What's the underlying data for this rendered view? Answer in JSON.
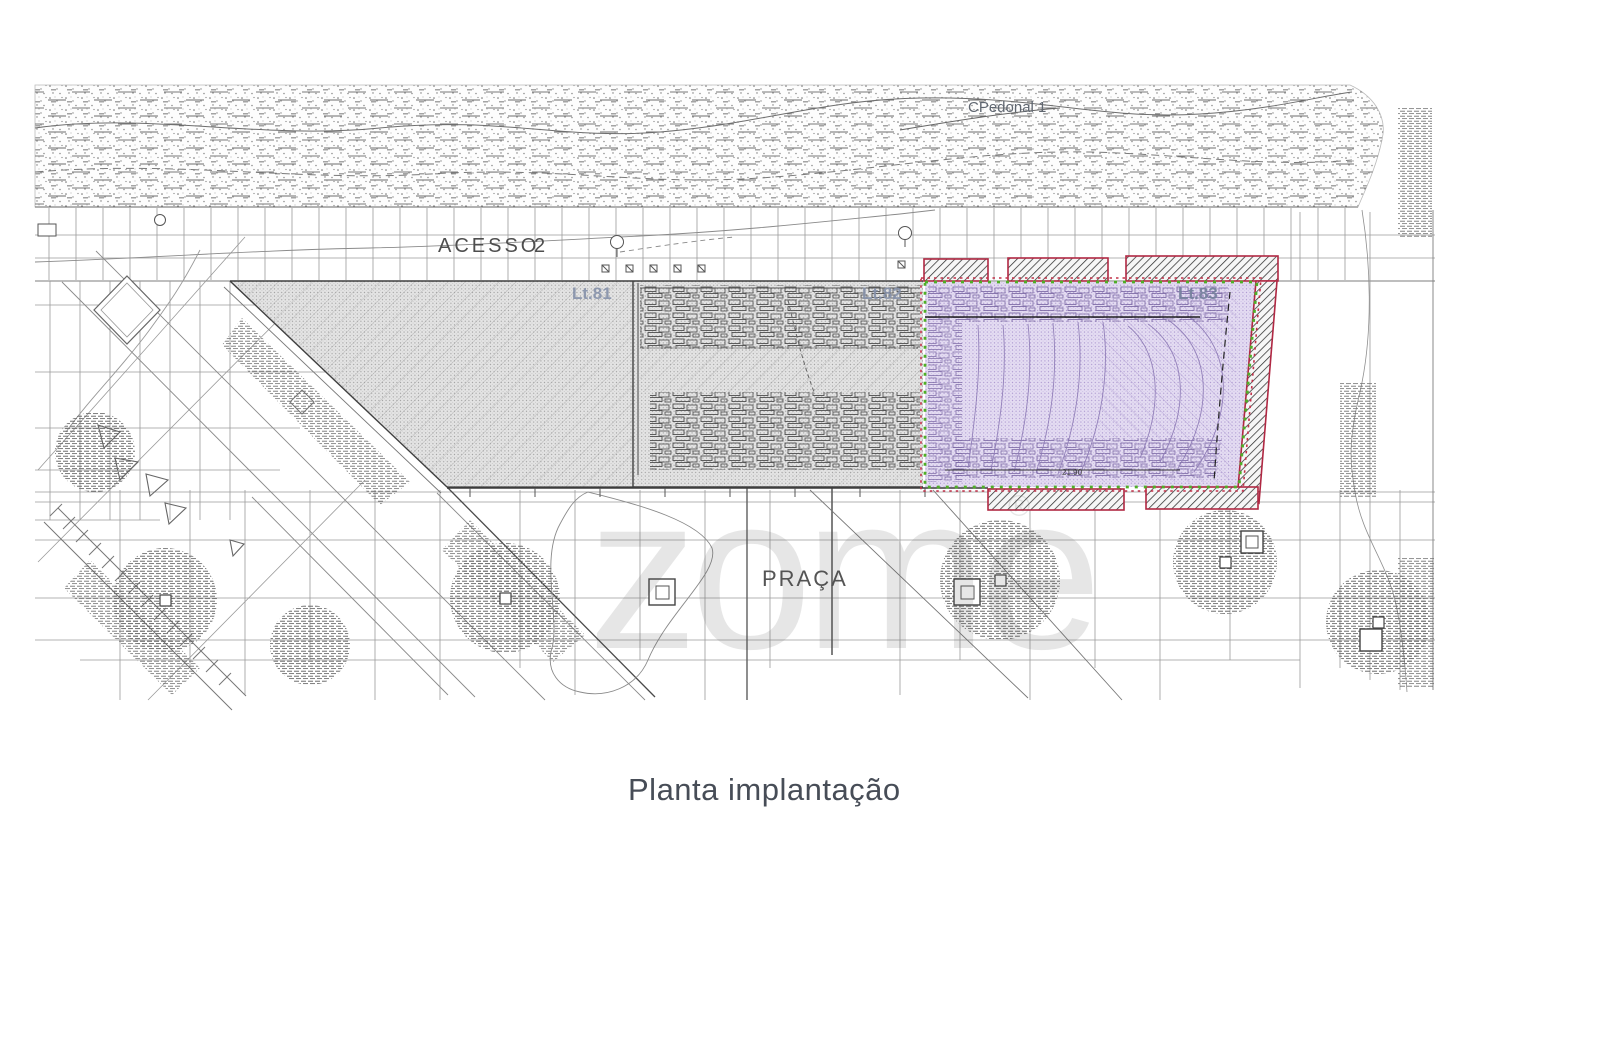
{
  "page": {
    "caption": "Planta implantação"
  },
  "watermark": {
    "text": "zome",
    "symbol": "®"
  },
  "plan": {
    "areas": {
      "pedestrian_path_label": "CPedonal 1",
      "access_road_label": "ACESSO",
      "access_road_number": "2",
      "lot_81_label": "Lt.81",
      "lot_82_label": "Lt.82",
      "lot_83_label": "Lt.83",
      "square_label": "PRAÇA"
    },
    "dimensions": {
      "lot_83_bottom_width": "21.90"
    },
    "colors": {
      "lot_fill_gray": "#e4e4e4",
      "lot_fill_purple": "#e4dcf2",
      "boundary_green": "#4fae27",
      "boundary_red": "#c23049",
      "lot_label_blue": "#8591aa",
      "caption_text": "#474d57"
    }
  }
}
